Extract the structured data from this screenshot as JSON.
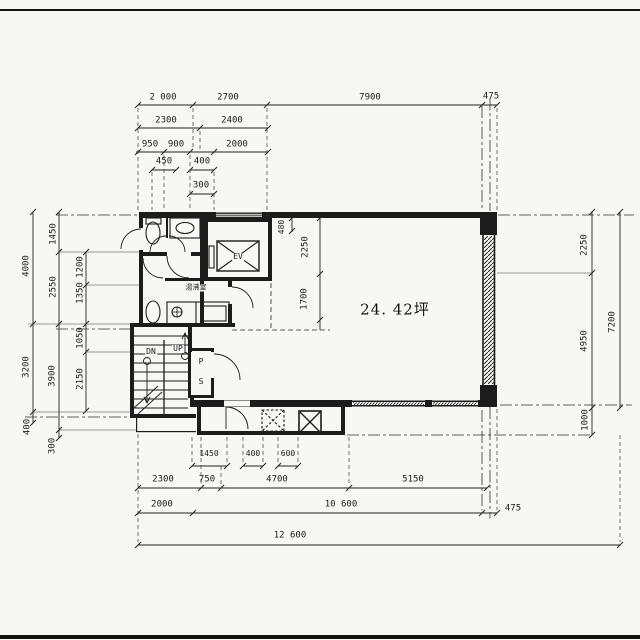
{
  "drawing": {
    "type": "architectural-floor-plan",
    "area_label": "24. 42坪",
    "labels": {
      "elevator": "EV",
      "kitchenette": "湯沸室",
      "stairs_down": "DN",
      "stairs_up": "UP",
      "pipe_shaft_p": "P",
      "pipe_shaft_s": "S"
    },
    "dims": {
      "top": {
        "row1": [
          "2 000",
          "2700",
          "7900",
          "475"
        ],
        "row2": [
          "2300",
          "2400"
        ],
        "row3": [
          "950",
          "900",
          "2000"
        ],
        "row4": [
          "450",
          "400"
        ],
        "row5": [
          "300"
        ]
      },
      "left": {
        "outer": [
          "4000",
          "3200",
          "400"
        ],
        "middle": [
          "1450",
          "2550",
          "3900",
          "300"
        ],
        "inner": [
          "1200",
          "1350",
          "1050",
          "2150"
        ]
      },
      "right": {
        "inner": [
          "2250",
          "4950",
          "1000"
        ],
        "outer": [
          "7200"
        ]
      },
      "bottom": {
        "row0": [
          "1450",
          "400",
          "600"
        ],
        "row1": [
          "2300",
          "750",
          "4700",
          "5150"
        ],
        "row2": [
          "2000",
          "10 600",
          "475"
        ],
        "row3": [
          "12 600"
        ]
      },
      "interior": [
        "480",
        "2250",
        "1700"
      ]
    },
    "colors": {
      "ink": "#1c1c1c",
      "paper": "#f7f7f4"
    }
  }
}
